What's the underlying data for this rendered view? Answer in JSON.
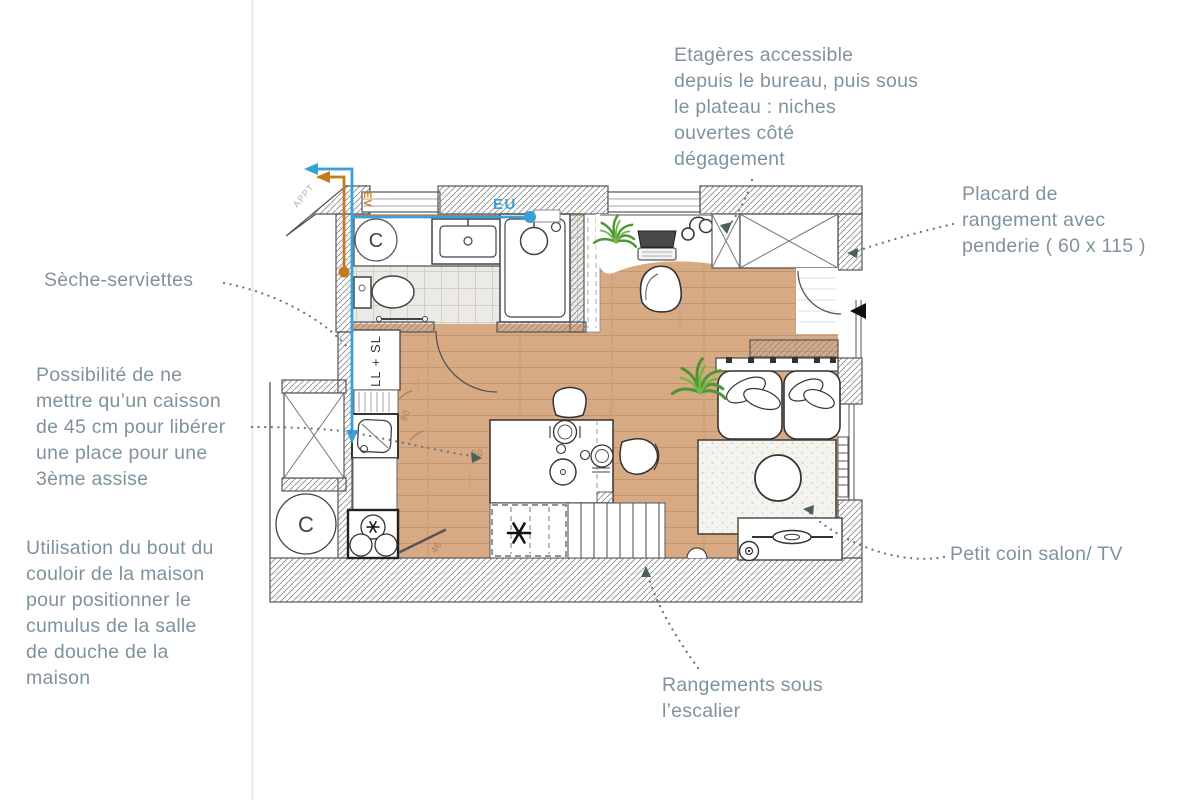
{
  "annotations": {
    "etageres": {
      "text": "Etagères accessible\ndepuis le bureau, puis sous\nle plateau : niches\nouvertes côté\ndégagement"
    },
    "placard": {
      "text": "Placard de\nrangement avec\npenderie ( 60 x 115 )"
    },
    "seche_serviettes": {
      "text": "Sèche-serviettes"
    },
    "possibilite": {
      "text": "Possibilité de ne\nmettre qu’un caisson\nde 45 cm pour libérer\nune place pour une\n3ème assise"
    },
    "utilisation": {
      "text": "Utilisation du bout du\ncouloir de la maison\npour positionner le\ncumulus de la salle\nde douche de la\nmaison"
    },
    "petit_coin": {
      "text": "Petit coin salon/ TV"
    },
    "rangements": {
      "text": "Rangements sous\nl’escalier"
    }
  },
  "plan_labels": {
    "eu": "EU",
    "ev": "EV",
    "cumulus_bathroom": "C",
    "cumulus_corridor": "C",
    "washer_column": "LL + SL",
    "appt": "APPT",
    "dim_80": "80",
    "dim_50": "50",
    "dim_46": "46"
  },
  "colors": {
    "annotation_text": "#7e939d",
    "floor_wood": "#d7aa84",
    "plank_line": "#c2966e",
    "tile_floor": "#eceae5",
    "pipe_eu_blue": "#3b9fd8",
    "pipe_ev_orange": "#c47a1e",
    "leader_dots": "#64787f",
    "leader_arrow": "#4a635a",
    "wall_line": "#555555",
    "plant_green": "#4f9637",
    "entrance_marker": "#111111"
  }
}
